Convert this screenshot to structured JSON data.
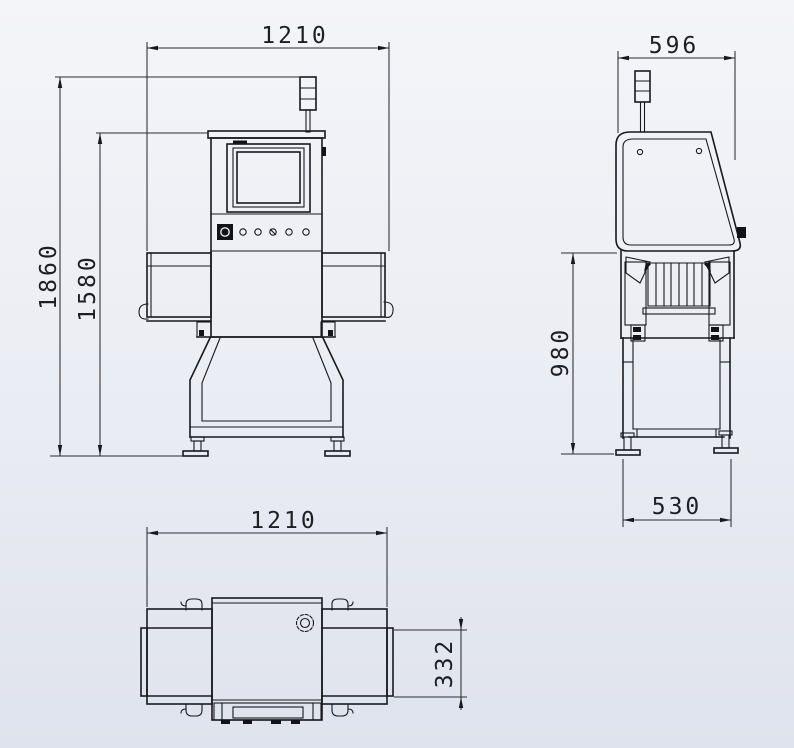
{
  "drawing": {
    "type": "engineering-dimension-drawing",
    "subject": "x-ray-inspection-machine",
    "colors": {
      "line": "#17191e",
      "bg_top": "#f4f5f9",
      "bg_bottom": "#dfe3ed",
      "dim_text": "#1d1f24"
    },
    "views": {
      "front": {
        "label": "front-view",
        "dims": {
          "overall_width": "1210",
          "overall_height": "1860",
          "machine_height": "1580"
        }
      },
      "side": {
        "label": "side-view",
        "dims": {
          "overall_depth": "596",
          "frame_height": "980",
          "base_depth": "530"
        }
      },
      "plan": {
        "label": "top-view",
        "dims": {
          "overall_width": "1210",
          "belt_width": "332"
        }
      }
    }
  }
}
